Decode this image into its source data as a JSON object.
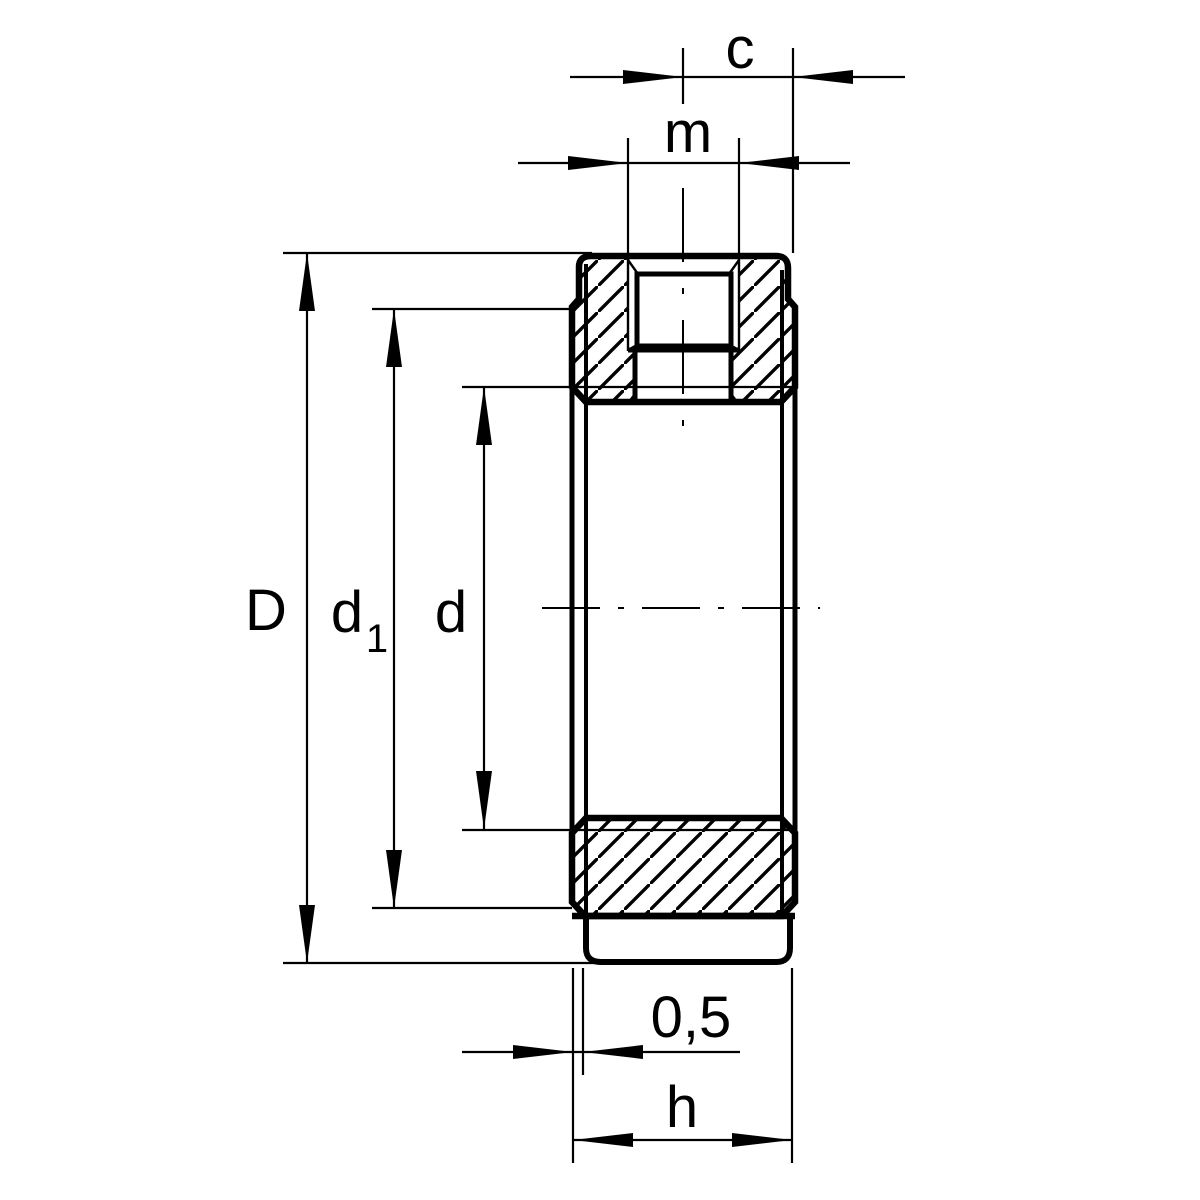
{
  "drawing": {
    "ink_color": "#000000",
    "paper_color": "#ffffff",
    "dimension_labels": {
      "c": "c",
      "m": "m",
      "outer_diameter": "D",
      "face_diameter_main": "d",
      "face_diameter_sub": "1",
      "bore_diameter": "d",
      "face_relief": "0,5",
      "height": "h"
    }
  }
}
